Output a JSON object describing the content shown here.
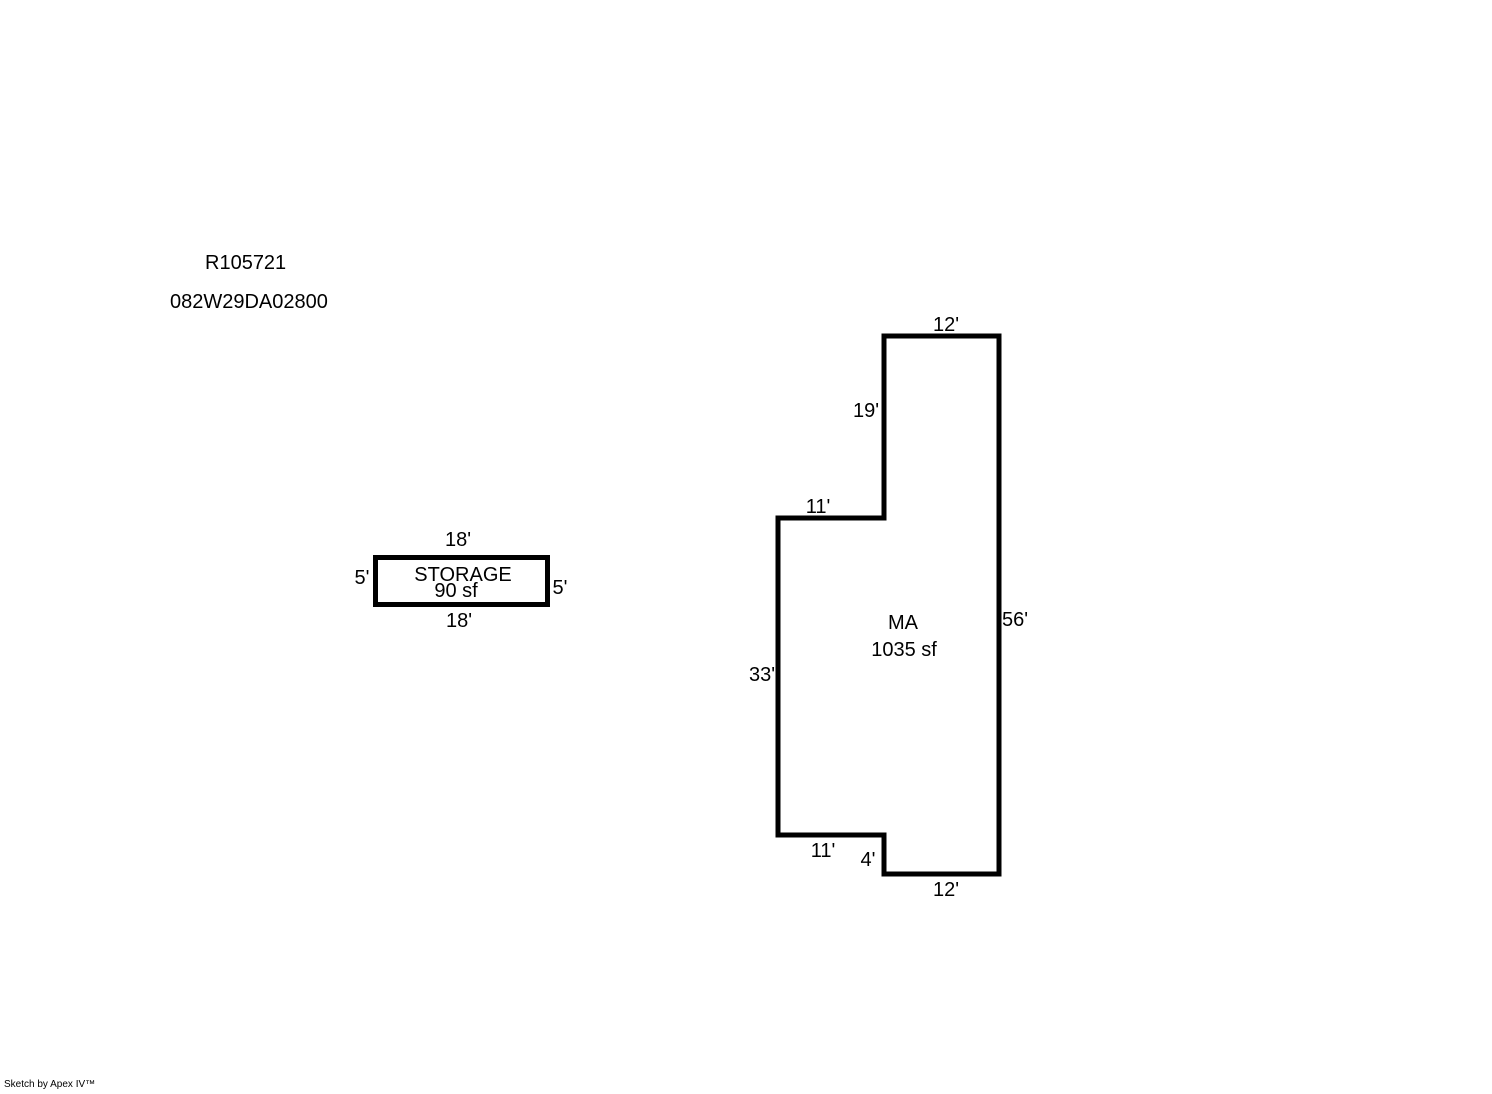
{
  "header": {
    "sketch_id": "R105721",
    "parcel_id": "082W29DA02800"
  },
  "storage": {
    "label": "STORAGE",
    "area": "90 sf",
    "dims": {
      "top": "18'",
      "left": "5'",
      "right": "5'",
      "bottom": "18'"
    }
  },
  "main_area": {
    "label": "MA",
    "area": "1035 sf",
    "dims": {
      "top": "12'",
      "upper_left": "19'",
      "step_upper": "11'",
      "left": "33'",
      "step_lower": "11'",
      "notch": "4'",
      "bottom": "12'",
      "right": "56'"
    }
  },
  "footer": {
    "credit": "Sketch by Apex IV™"
  }
}
